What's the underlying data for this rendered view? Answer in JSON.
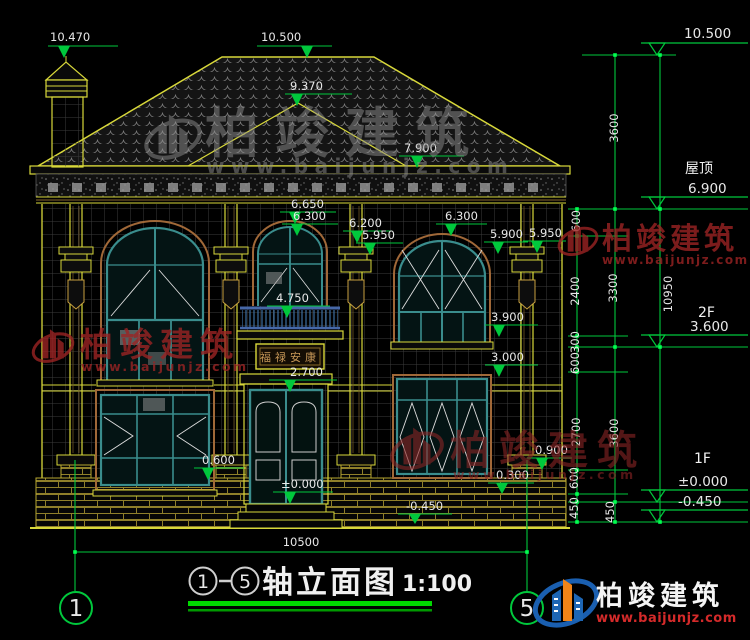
{
  "drawing": {
    "title_prefix_axis": "1",
    "title_suffix_axis": "5",
    "title": "轴立面图",
    "scale": "1:100",
    "bottom_overall_dim": "10500",
    "axis_bubble_left": "1",
    "axis_bubble_right": "5",
    "plaque_text": "福禄安康"
  },
  "floor_labels": [
    {
      "text": "屋顶"
    },
    {
      "text": "2F"
    },
    {
      "text": "1F"
    }
  ],
  "levels": [
    {
      "value": "10.500",
      "tx": 684,
      "ty": 38,
      "ly": 43,
      "lx1": 641,
      "lx2": 748,
      "ax": 657,
      "ay": 55
    },
    {
      "value": "6.900",
      "tx": 688,
      "ty": 193,
      "ly": 197,
      "lx1": 641,
      "lx2": 748,
      "ax": 657,
      "ay": 209
    },
    {
      "value": "3.600",
      "tx": 690,
      "ty": 331,
      "ly": 335,
      "lx1": 641,
      "lx2": 748,
      "ax": 657,
      "ay": 347
    },
    {
      "value": "±0.000",
      "tx": 678,
      "ty": 486,
      "ly": 490,
      "lx1": 641,
      "lx2": 748,
      "ax": 657,
      "ay": 502
    },
    {
      "value": "-0.450",
      "tx": 678,
      "ty": 506,
      "ly": 510,
      "lx1": 641,
      "lx2": 748,
      "ax": 657,
      "ay": 522
    }
  ],
  "elevation_markers": [
    {
      "value": "10.470",
      "tx": 50,
      "ty": 41,
      "ly": 46,
      "lx1": 48,
      "lx2": 118,
      "ax": 64,
      "ay": 58
    },
    {
      "value": "10.500",
      "tx": 261,
      "ty": 41,
      "ly": 46,
      "lx1": 257,
      "lx2": 332,
      "ax": 307,
      "ay": 58
    },
    {
      "value": "9.370",
      "tx": 290,
      "ty": 90,
      "ly": 94,
      "lx1": 285,
      "lx2": 352,
      "ax": 297,
      "ay": 106
    },
    {
      "value": "7.900",
      "tx": 404,
      "ty": 152,
      "ly": 156,
      "lx1": 399,
      "lx2": 464,
      "ax": 417,
      "ay": 168
    },
    {
      "value": "6.650",
      "tx": 291,
      "ty": 208,
      "ly": 212,
      "lx1": 280,
      "lx2": 336,
      "ax": 295,
      "ay": 224
    },
    {
      "value": "6.300",
      "tx": 293,
      "ty": 220,
      "ly": 224,
      "lx1": 282,
      "lx2": 338,
      "ax": 297,
      "ay": 236
    },
    {
      "value": "6.200",
      "tx": 349,
      "ty": 227,
      "ly": 231,
      "lx1": 343,
      "lx2": 392,
      "ax": 357,
      "ay": 243
    },
    {
      "value": "5.950",
      "tx": 362,
      "ty": 239,
      "ly": 243,
      "lx1": 356,
      "lx2": 403,
      "ax": 370,
      "ay": 255
    },
    {
      "value": "6.300",
      "tx": 445,
      "ty": 220,
      "ly": 224,
      "lx1": 436,
      "lx2": 487,
      "ax": 451,
      "ay": 236
    },
    {
      "value": "5.900",
      "tx": 490,
      "ty": 238,
      "ly": 242,
      "lx1": 484,
      "lx2": 528,
      "ax": 498,
      "ay": 254
    },
    {
      "value": "5.950",
      "tx": 529,
      "ty": 237,
      "ly": 241,
      "lx1": 523,
      "lx2": 566,
      "ax": 537,
      "ay": 253
    },
    {
      "value": "4.750",
      "tx": 276,
      "ty": 302,
      "ly": 306,
      "lx1": 267,
      "lx2": 330,
      "ax": 287,
      "ay": 318
    },
    {
      "value": "3.900",
      "tx": 491,
      "ty": 321,
      "ly": 325,
      "lx1": 485,
      "lx2": 538,
      "ax": 499,
      "ay": 337
    },
    {
      "value": "3.000",
      "tx": 491,
      "ty": 361,
      "ly": 365,
      "lx1": 485,
      "lx2": 538,
      "ax": 499,
      "ay": 377
    },
    {
      "value": "2.700",
      "tx": 290,
      "ty": 376,
      "ly": 380,
      "lx1": 269,
      "lx2": 337,
      "ax": 290,
      "ay": 392
    },
    {
      "value": "0.600",
      "tx": 202,
      "ty": 464,
      "ly": 468,
      "lx1": 194,
      "lx2": 244,
      "ax": 208,
      "ay": 480
    },
    {
      "value": "0.900",
      "tx": 535,
      "ty": 454,
      "ly": 458,
      "lx1": 527,
      "lx2": 572,
      "ax": 542,
      "ay": 470
    },
    {
      "value": "0.300",
      "tx": 496,
      "ty": 479,
      "ly": 483,
      "lx1": 488,
      "lx2": 534,
      "ax": 502,
      "ay": 494
    },
    {
      "value": "-0.450",
      "tx": 406,
      "ty": 510,
      "ly": 514,
      "lx1": 398,
      "lx2": 452,
      "ax": 415,
      "ay": 524
    },
    {
      "value": "±0.000",
      "tx": 281,
      "ty": 488,
      "ly": 492,
      "lx1": 273,
      "lx2": 333,
      "ax": 290,
      "ay": 504
    }
  ],
  "vertical_dims": [
    {
      "value": "3600",
      "x": 618,
      "y": 128
    },
    {
      "value": "600",
      "x": 580,
      "y": 221
    },
    {
      "value": "2400",
      "x": 579,
      "y": 291
    },
    {
      "value": "3300",
      "x": 617,
      "y": 288
    },
    {
      "value": "10950",
      "x": 672,
      "y": 294
    },
    {
      "value": "300",
      "x": 579,
      "y": 342
    },
    {
      "value": "600",
      "x": 579,
      "y": 363
    },
    {
      "value": "2700",
      "x": 580,
      "y": 432
    },
    {
      "value": "3600",
      "x": 618,
      "y": 433
    },
    {
      "value": "600",
      "x": 578,
      "y": 478
    },
    {
      "value": "450",
      "x": 578,
      "y": 508
    },
    {
      "value": "450",
      "x": 614,
      "y": 512
    }
  ],
  "watermark": {
    "name": "柏竣建筑",
    "url": "www.baijunjz.com"
  },
  "logo": {
    "name": "柏竣建筑",
    "url": "www.baijunjz.com"
  },
  "colors": {
    "dim_green": "#00c83c",
    "node_green": "#00ff50",
    "outline_yellow": "#d8d83a",
    "window_teal": "#3a8d8d",
    "trim_tan": "#a06838",
    "watermark_red": "#9b2424",
    "logo_blue": "#1d66b5",
    "logo_orange": "#f08418",
    "logo_url_red": "#d42a2a"
  }
}
